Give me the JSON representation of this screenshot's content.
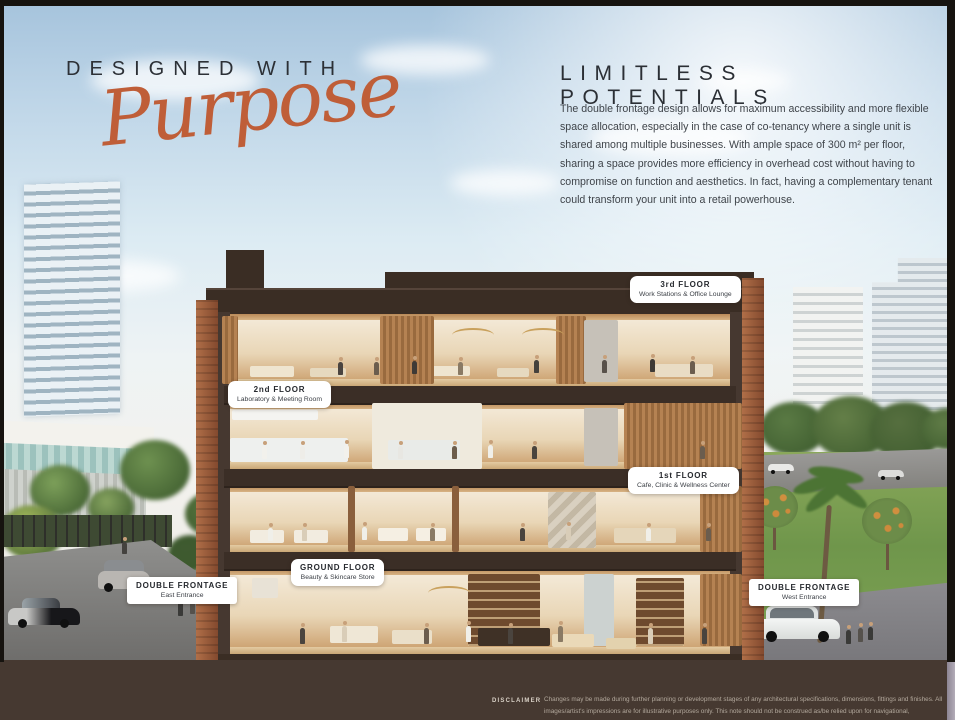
{
  "header": {
    "designed_with": "DESIGNED WITH",
    "purpose_script": "Purpose",
    "limitless": "LIMITLESS POTENTIALS",
    "paragraph": "The double frontage design allows for maximum accessibility and more flexible space allocation, especially in the case of co-tenancy where a single unit is shared among multiple businesses. With ample space of 300 m² per floor, sharing a space provides more efficiency in overhead cost without having to compromise on function and aesthetics. In fact, having a complementary tenant could transform your unit into a retail powerhouse."
  },
  "labels": {
    "floors": [
      {
        "title": "3rd FLOOR",
        "subtitle": "Work Stations & Office Lounge"
      },
      {
        "title": "2nd FLOOR",
        "subtitle": "Laboratory & Meeting Room"
      },
      {
        "title": "1st FLOOR",
        "subtitle": "Cafe, Clinic & Wellness Center"
      },
      {
        "title": "GROUND FLOOR",
        "subtitle": "Beauty & Skincare Store"
      }
    ],
    "entrances": [
      {
        "title": "DOUBLE FRONTAGE",
        "subtitle": "East Entrance"
      },
      {
        "title": "DOUBLE FRONTAGE",
        "subtitle": "West Entrance"
      }
    ]
  },
  "disclaimer": {
    "label": "DISCLAIMER",
    "text": "Changes may be made during further planning or development stages of any architectural specifications, dimensions, fittings and finishes. All images/artist's impressions are for illustrative purposes only. This note should not be construed as/be relied upon for navigational, engineering, legal or other site-specific uses."
  },
  "colors": {
    "accent_orange": "#bf5e38",
    "heading_dark": "#2b2f35",
    "band_brown": "#463931",
    "frame_brown": "#3a2d24",
    "brick": "#9a5f40",
    "pill_bg": "#ffffff",
    "pill_text": "#26292e"
  }
}
